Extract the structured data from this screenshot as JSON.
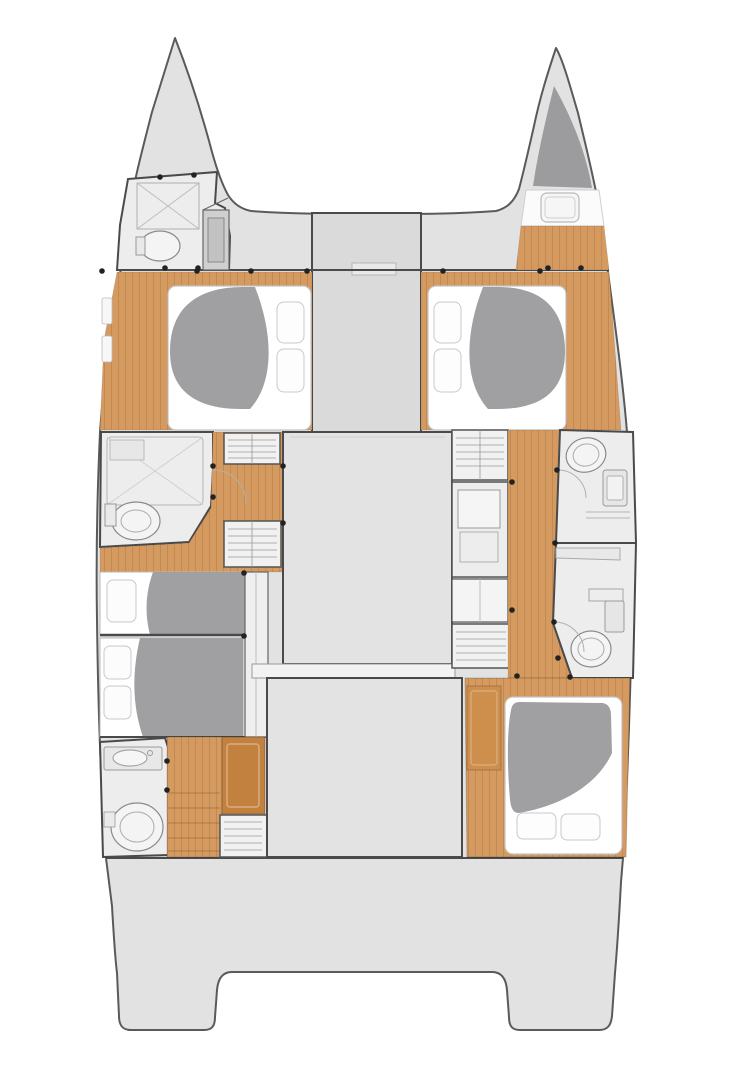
{
  "page": {
    "title": "Sailing catamaran interior deck plan",
    "view": "top-down hull layout"
  },
  "colors": {
    "background": "#ffffff",
    "deck": "#e2e2e2",
    "deck_dark": "#dadada",
    "block": "#e3e3e3",
    "floor": "#ededed",
    "wood": "#d49a5f",
    "wood_dark": "#c2813e",
    "duvet": "#a0a0a2",
    "berth_dark": "#9c9c9e",
    "mattress": "#ffffff",
    "outline": "#4a4a4a",
    "hull_outline": "#5a5a5a",
    "fixture": "#8a8a8a",
    "drawer_line": "#9a9a9a"
  },
  "plan": {
    "vessel": "sailing-catamaran",
    "hull_port_rooms": [
      "bow-bathroom",
      "forward-cabin",
      "mid-bathroom",
      "companionway",
      "aft-berth-1",
      "aft-berth-2",
      "aft-bathroom",
      "companionway-steps"
    ],
    "hull_starboard_rooms": [
      "forepeak-berth",
      "forward-cabin",
      "storage-units",
      "companionway",
      "forward-bathroom",
      "aft-bathroom",
      "aft-cabin"
    ],
    "center_structures": [
      "foredeck",
      "crossdeck-band",
      "central-column",
      "saloon-block",
      "aft-block",
      "stern-platform"
    ],
    "summary": {
      "double_beds": 3,
      "single_berths": 2,
      "bathrooms": 5,
      "shower_trays": 2,
      "toilets": 5,
      "sinks": 3,
      "drawer_units": 5,
      "deck_hatches": 1
    }
  }
}
